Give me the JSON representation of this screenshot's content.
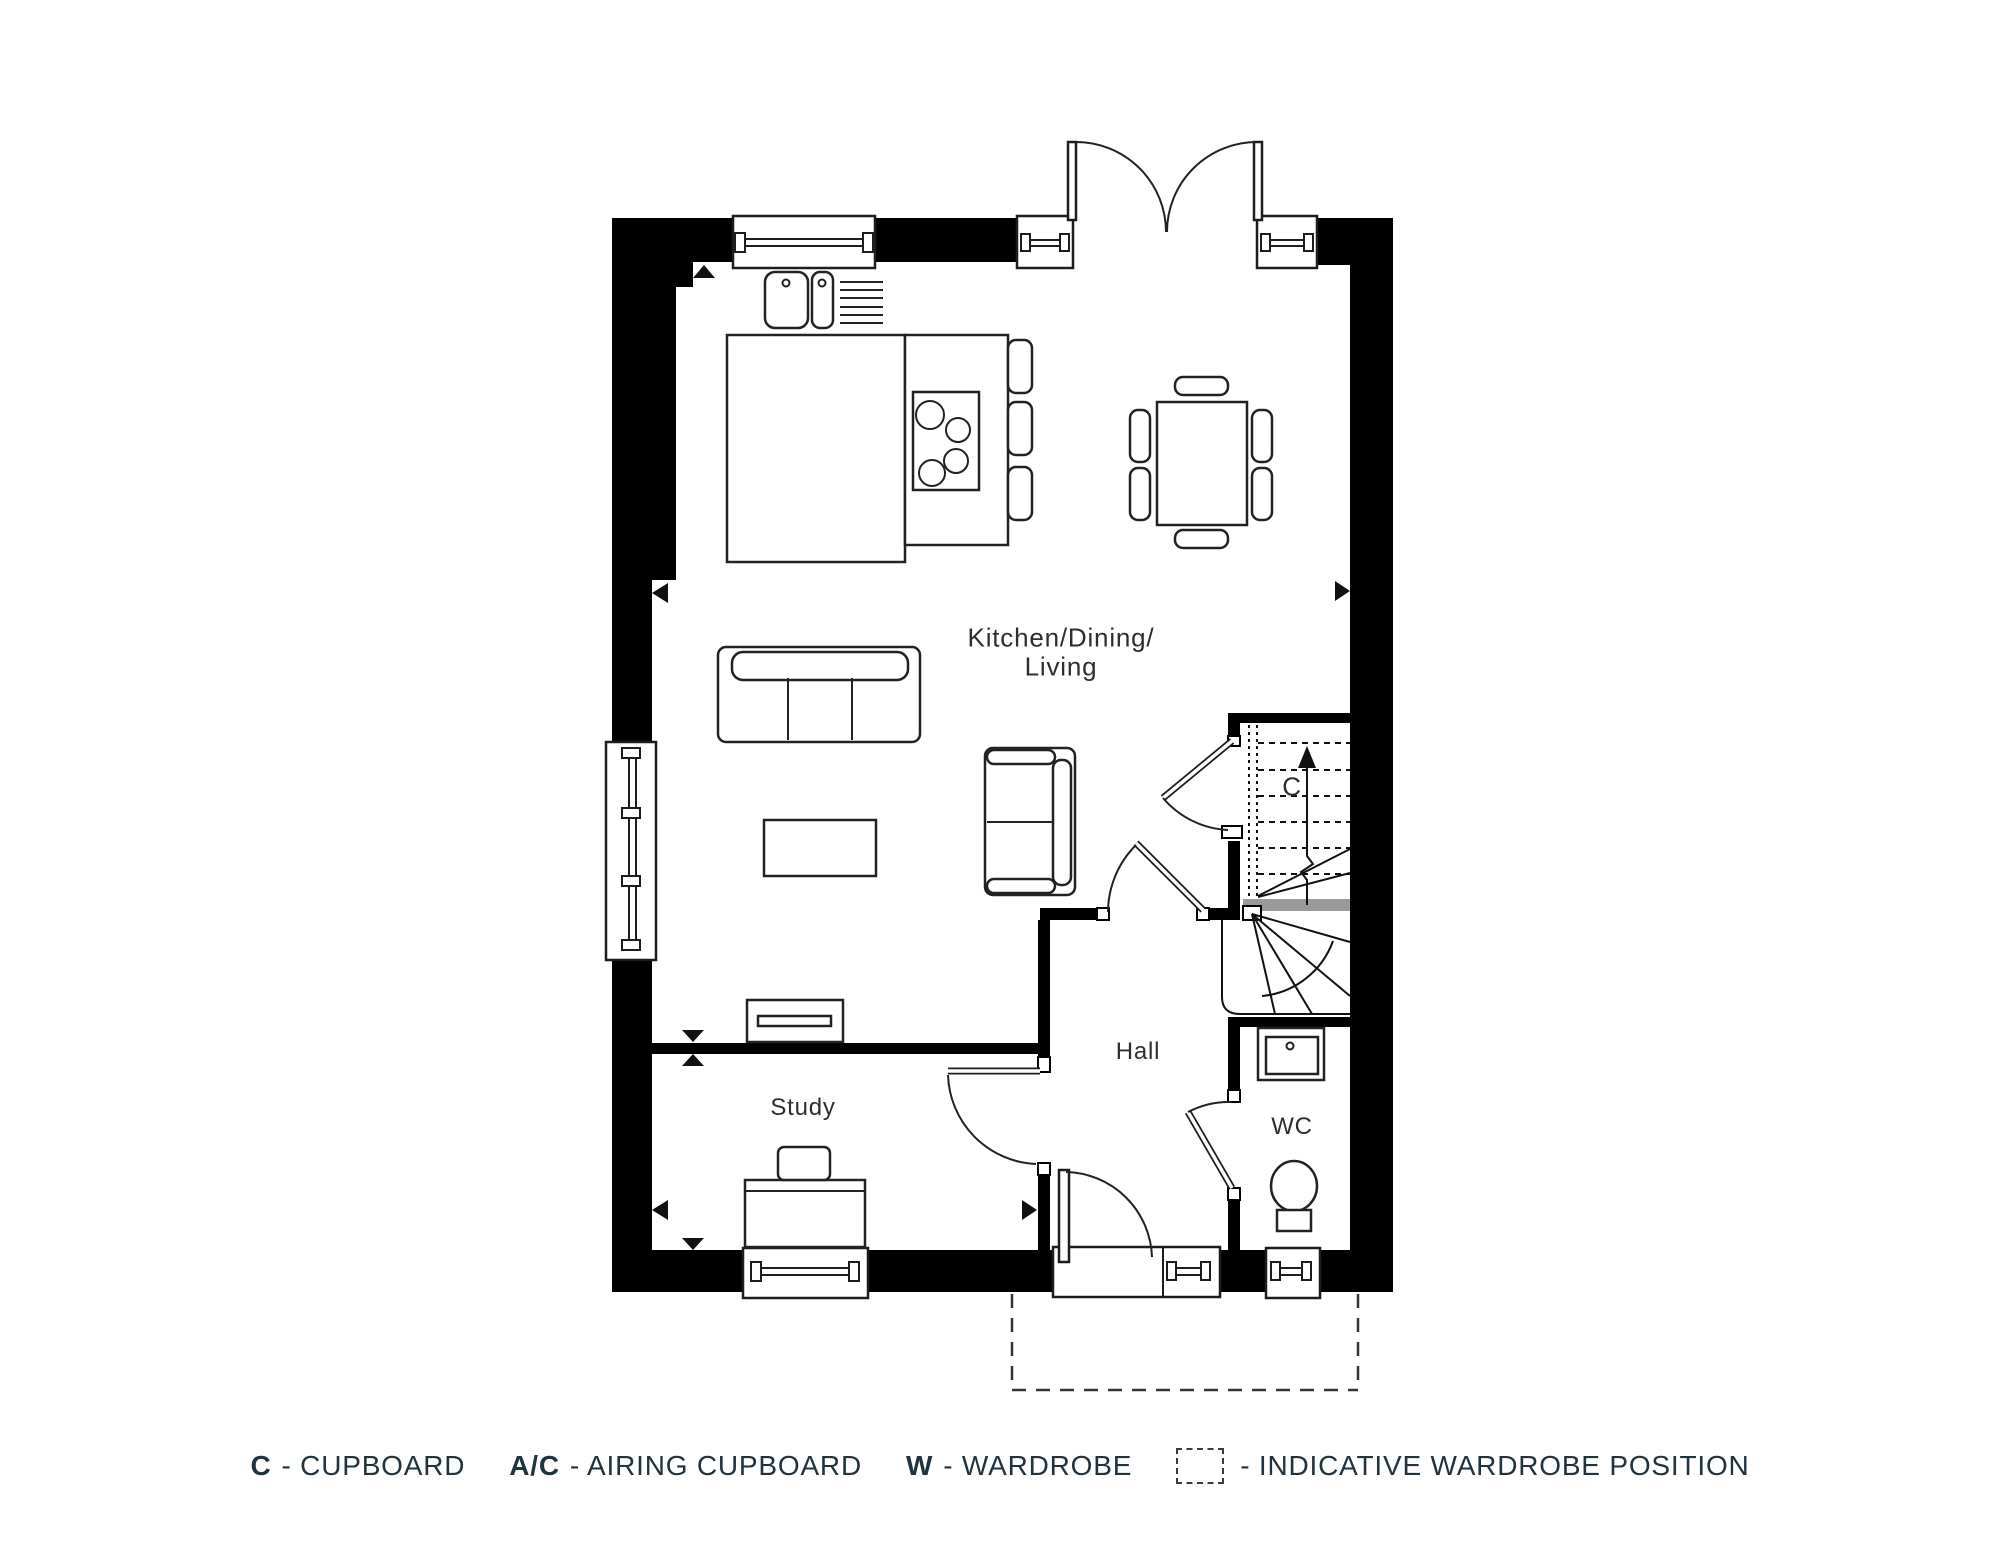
{
  "rooms": {
    "kitchen_living": {
      "line1": "Kitchen/Dining/",
      "line2": "Living"
    },
    "study": "Study",
    "hall": "Hall",
    "wc": "WC",
    "stairs_cupboard": "C"
  },
  "legend": {
    "items": [
      {
        "symbol": "C",
        "label": "- CUPBOARD"
      },
      {
        "symbol": "A/C",
        "label": "- AIRING CUPBOARD"
      },
      {
        "symbol": "W",
        "label": "- WARDROBE"
      },
      {
        "symbol": "",
        "icon": "dashed-box",
        "label": "- INDICATIVE WARDROBE POSITION"
      }
    ]
  },
  "colors": {
    "background": "#ffffff",
    "wall": "#000000",
    "line": "#222222",
    "stair_landing_gray": "#9a9a9a",
    "room_label_text": "#2e2e2e",
    "legend_text": "#20333f"
  }
}
